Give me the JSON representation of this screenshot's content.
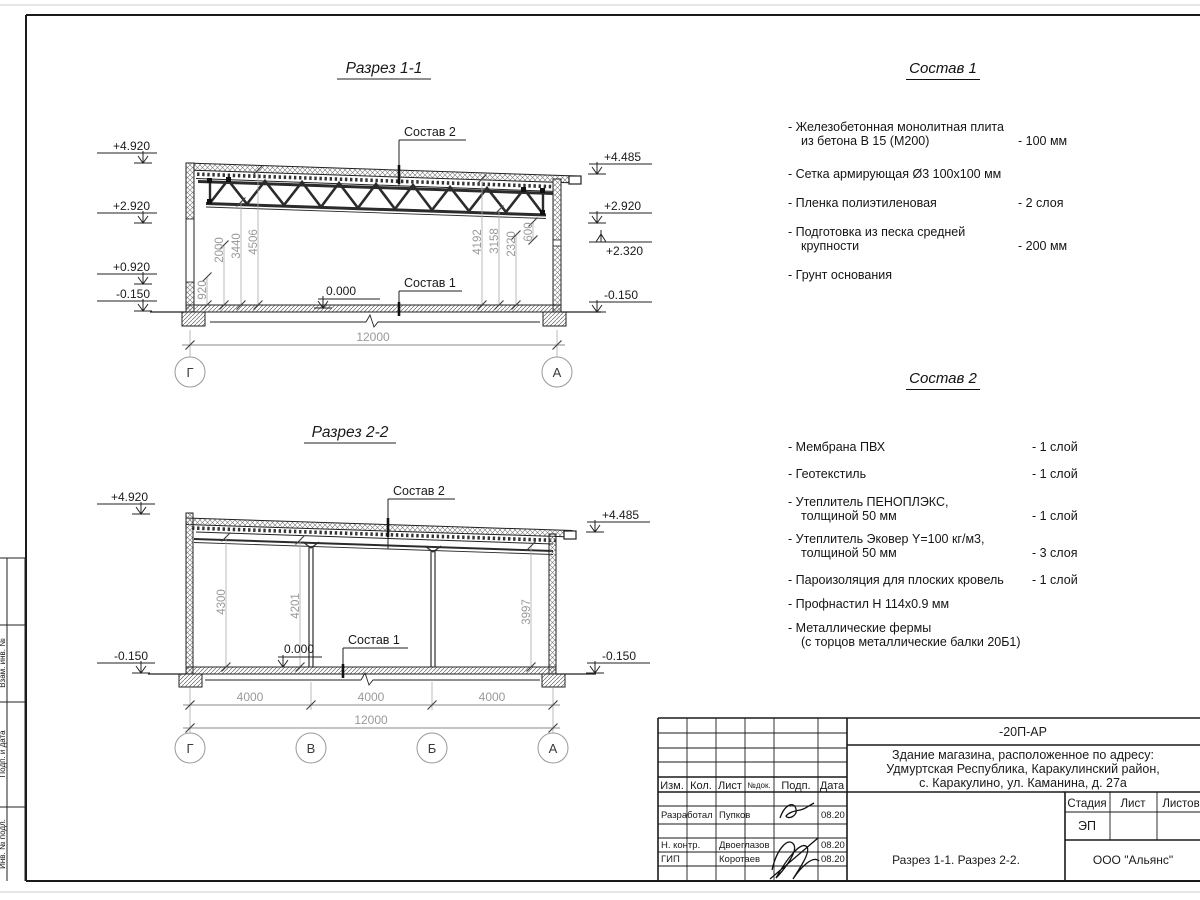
{
  "sheet": {
    "side_column_labels": [
      "Взам. инв. №",
      "Подп. и дата",
      "Инв. № подл."
    ]
  },
  "section1": {
    "title": "Разрез 1-1",
    "sostav2_label": "Состав 2",
    "sostav1_label": "Состав 1",
    "zero": "0.000",
    "elev_left": [
      "+4.920",
      "+2.920",
      "+0.920",
      "-0.150"
    ],
    "elev_right": [
      "+4.485",
      "+2.920",
      "+2.320",
      "-0.150"
    ],
    "dims_left": [
      "920",
      "2000",
      "3440",
      "4506"
    ],
    "dims_right": [
      "4192",
      "3158",
      "2320",
      "600"
    ],
    "total_dim": "12000",
    "axis_left": "Г",
    "axis_right": "А"
  },
  "section2": {
    "title": "Разрез 2-2",
    "sostav2_label": "Состав 2",
    "sostav1_label": "Состав 1",
    "zero": "0.000",
    "elev_left": [
      "+4.920",
      "-0.150"
    ],
    "elev_right": [
      "+4.485",
      "-0.150"
    ],
    "dims_vert": [
      "4300",
      "4201",
      "3997"
    ],
    "dims_span": [
      "4000",
      "4000",
      "4000"
    ],
    "total_dim": "12000",
    "axes": [
      "Г",
      "В",
      "Б",
      "А"
    ]
  },
  "sostav1": {
    "title": "Состав 1",
    "items": [
      {
        "lines": [
          "- Железобетонная  монолитная плита",
          "из бетона В 15 (М200)"
        ],
        "qty": "- 100 мм"
      },
      {
        "lines": [
          "- Сетка армирующая Ø3 100х100 мм",
          ""
        ],
        "qty": ""
      },
      {
        "lines": [
          "- Пленка полиэтиленовая",
          ""
        ],
        "qty": "-  2 слоя"
      },
      {
        "lines": [
          "- Подготовка из песка средней",
          "крупности"
        ],
        "qty": "- 200 мм"
      },
      {
        "lines": [
          "- Грунт основания",
          ""
        ],
        "qty": ""
      }
    ]
  },
  "sostav2": {
    "title": "Состав 2",
    "items": [
      {
        "lines": [
          "- Мембрана ПВХ",
          ""
        ],
        "qty": "- 1 слой"
      },
      {
        "lines": [
          "- Геотекстиль",
          ""
        ],
        "qty": "- 1 слой"
      },
      {
        "lines": [
          "- Утеплитель ПЕНОПЛЭКС,",
          "толщиной 50 мм"
        ],
        "qty": "- 1 слой"
      },
      {
        "lines": [
          "- Утеплитель Эковер Y=100 кг/м3,",
          "толщиной 50 мм"
        ],
        "qty": "- 3 слоя"
      },
      {
        "lines": [
          "- Пароизоляция для плоских кровель",
          ""
        ],
        "qty": "- 1 слой"
      },
      {
        "lines": [
          "- Профнастил Н 114х0.9 мм",
          ""
        ],
        "qty": ""
      },
      {
        "lines": [
          "- Металлические фермы",
          "(с торцов металлические балки 20Б1)"
        ],
        "qty": ""
      }
    ]
  },
  "titleblock": {
    "doc_code": "-20П-АР",
    "address": [
      "Здание магазина, расположенное по адресу:",
      "Удмуртская Республика, Каракулинский район,",
      "с. Каракулино, ул. Каманина, д. 27а"
    ],
    "cols": [
      "Изм.",
      "Кол.",
      "Лист",
      "№док.",
      "Подп.",
      "Дата"
    ],
    "rows": [
      {
        "role": "Разработал",
        "name": "Пупков",
        "date": "08.20"
      },
      {
        "role": "Н. контр.",
        "name": "Двоеглазов",
        "date": "08.20"
      },
      {
        "role": "ГИП",
        "name": "Коротаев",
        "date": "08.20"
      }
    ],
    "stage_cols": [
      "Стадия",
      "Лист",
      "Листов"
    ],
    "stage": "ЭП",
    "sheet_name": "Разрез 1-1. Разрез 2-2.",
    "company": "ООО \"Альянс\""
  },
  "colors": {
    "line": "#1a1a1a",
    "dim_text": "#9a9a9a",
    "hatch": "#666666",
    "paper_edge": "#cccccc"
  }
}
